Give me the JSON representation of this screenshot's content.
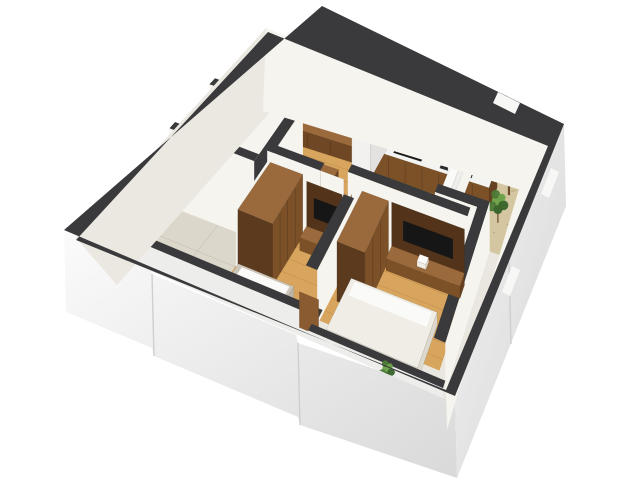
{
  "meta": {
    "description": "3D isometric cutaway render of an apartment floor plan with living room, kitchen, two bedrooms, bathrooms and balcony"
  },
  "palette": {
    "cap": "#3a3a3c",
    "white_face": "#f6f4ef",
    "shadow_face": "#ebe8e1",
    "wall_lower": "#ededeb",
    "wood_floor": "#d8a55e",
    "plank": "#a87434",
    "tile": "#dcd7cb",
    "tile_seam": "#c6bfaf",
    "balc_tile": "#d3c6a0",
    "balc_dot": "#b3a176",
    "entry_floor": "#eae7e0",
    "wood_mid": "#7c5128",
    "wood_light": "#9a6a3c",
    "wood_dark": "#5b3a1e",
    "wood_side": "#674021",
    "console": "#6f4724",
    "panel": "#53341a",
    "niche": "#3a2614",
    "slat": "#8a6239",
    "slat_gap": "#f1ede4",
    "counter": "#f3f3f1",
    "tv_black": "#161616",
    "cooktop": "#1b1b1b",
    "sink": "#2b2b2b",
    "sink_grate": "#121212",
    "fridge_top": "#ececea",
    "fridge_front": "#f2f1ef",
    "fridge_side": "#e3e2e0",
    "door": "#8a5a30",
    "frame": "#a9743f",
    "bed_gray": "#ccc5b8",
    "bed_gray_d": "#bdb5a6",
    "bed_white": "#efede6",
    "bed_white_d": "#ddd9cf",
    "pillow": "#fafaf8",
    "green1": "#4c7a36",
    "green2": "#6aa148",
    "green3": "#38642a",
    "trunk": "#6b4a2a",
    "window_white": "#f7f7f5",
    "facade_seam": "#cfcfcf"
  },
  "scene": [
    {
      "op": "raw",
      "name": "exterior-facade-sw",
      "fill": "url(#gradSW)",
      "pts": [
        [
          64,
          230
        ],
        [
          150,
          266
        ],
        [
          152,
          274
        ],
        [
          296,
          335
        ],
        [
          298,
          343
        ],
        [
          455,
          396
        ],
        [
          457,
          478
        ],
        [
          300,
          425
        ],
        [
          298,
          417
        ],
        [
          154,
          356
        ],
        [
          152,
          348
        ],
        [
          66,
          312
        ]
      ]
    },
    {
      "op": "rawline",
      "name": "facade-sw-seam-1",
      "stroke": "facade_seam",
      "sw": 1.4,
      "pts": [
        [
          152,
          274
        ],
        [
          154,
          356
        ]
      ]
    },
    {
      "op": "rawline",
      "name": "facade-sw-seam-2",
      "stroke": "facade_seam",
      "sw": 1.4,
      "pts": [
        [
          298,
          343
        ],
        [
          300,
          425
        ]
      ]
    },
    {
      "op": "raw",
      "name": "exterior-facade-se",
      "fill": "url(#gradSE)",
      "pts": [
        [
          564,
          124
        ],
        [
          455,
          396
        ],
        [
          457,
          478
        ],
        [
          566,
          206
        ]
      ]
    },
    {
      "op": "rawline",
      "name": "facade-se-seam",
      "stroke": "facade_seam",
      "sw": 1.4,
      "pts": [
        [
          509,
          262
        ],
        [
          511,
          344
        ]
      ]
    },
    {
      "op": "planks",
      "name": "floor-living-kitchen",
      "r": [
        0.02,
        0.02,
        0.78,
        0.455
      ],
      "z": 0,
      "fill": "wood_floor",
      "step": 0.05
    },
    {
      "op": "planks",
      "name": "floor-hallway",
      "r": [
        0.44,
        0.42,
        0.56,
        0.5
      ],
      "z": 0,
      "fill": "wood_floor",
      "step": 0.05
    },
    {
      "op": "planks",
      "name": "floor-bedroom1",
      "r": [
        0.26,
        0.49,
        0.555,
        0.8
      ],
      "z": 0,
      "fill": "wood_floor",
      "step": 0.06
    },
    {
      "op": "planks",
      "name": "floor-bedroom2",
      "r": [
        0.555,
        0.455,
        0.93,
        0.87
      ],
      "z": 0,
      "fill": "wood_floor",
      "step": 0.06
    },
    {
      "op": "tiles",
      "name": "floor-bathroom1",
      "r": [
        0.02,
        0.3,
        0.26,
        0.585
      ],
      "z": 0,
      "fill": "tile"
    },
    {
      "op": "tiles",
      "name": "floor-bathroom2",
      "r": [
        0.02,
        0.585,
        0.26,
        0.8
      ],
      "z": 0,
      "fill": "tile"
    },
    {
      "op": "quad",
      "name": "floor-entry-corridor",
      "r": [
        -0.02,
        0.8,
        0.97,
        1.01
      ],
      "z": 0,
      "fill": "entry_floor"
    },
    {
      "op": "quad",
      "name": "floor-corridor-se",
      "r": [
        0.93,
        0.3,
        1.02,
        0.87
      ],
      "z": 0,
      "fill": "entry_floor"
    },
    {
      "op": "quad",
      "name": "floor-balcony",
      "r": [
        0.815,
        -0.03,
        1.03,
        0.3
      ],
      "z": 0,
      "fill": "balc_tile"
    },
    {
      "op": "dots",
      "name": "balcony-floor-speckle",
      "r": [
        0.82,
        0.0,
        1.0,
        0.28
      ],
      "n": 26,
      "fill": "balc_dot"
    },
    {
      "op": "raw",
      "name": "wall-nw-interior-face",
      "fill": "shadow_face",
      "pts": [
        [
          266,
          28
        ],
        [
          76,
          238
        ],
        [
          117,
          285
        ],
        [
          272,
          110
        ]
      ]
    },
    {
      "op": "raw",
      "name": "wall-ne-interior-face",
      "fill": "white_face",
      "pts": [
        [
          266,
          28
        ],
        [
          552,
          146
        ],
        [
          531,
          193
        ],
        [
          263,
          111
        ]
      ]
    },
    {
      "op": "raw",
      "name": "wall-se-interior-face",
      "fill": "white_face",
      "pts": [
        [
          552,
          146
        ],
        [
          446,
          392
        ],
        [
          447,
          430
        ],
        [
          519,
          189
        ]
      ]
    },
    {
      "op": "slabV",
      "name": "entrance-door-frame",
      "u": 0.024,
      "v1": 0.095,
      "v2": 0.225,
      "z1": 0,
      "z2": 69,
      "fill": "frame"
    },
    {
      "op": "slabV",
      "name": "entrance-door",
      "u": 0.025,
      "v1": 0.105,
      "v2": 0.215,
      "z1": 2,
      "z2": 66,
      "fill": "door"
    },
    {
      "op": "slabU",
      "name": "slat-wall-backing",
      "v": 0.045,
      "u1": 0.02,
      "u2": 0.45,
      "z1": 2,
      "z2": 76,
      "fill": "slat_gap"
    },
    {
      "op": "slats",
      "name": "slat-accent-wall",
      "v": 0.042,
      "u1": 0.035,
      "u2": 0.445,
      "z1": 3,
      "z2": 75,
      "count": 21,
      "fill": "slat"
    },
    {
      "op": "box",
      "name": "tv-console-living",
      "r": [
        0.06,
        0.05,
        0.4,
        0.135
      ],
      "h2": 16,
      "top": "wood_light",
      "uf": "wood_side",
      "vf": "console",
      "seamsU": 3
    },
    {
      "op": "slabU",
      "name": "tv-living",
      "v": 0.06,
      "u1": 0.15,
      "u2": 0.315,
      "z1": 18,
      "z2": 46,
      "fill": "tv_black"
    },
    {
      "op": "box",
      "name": "desk-living",
      "r": [
        0.26,
        0.25,
        0.4,
        0.33
      ],
      "h2": 17,
      "top": "wood_light",
      "uf": "wood_side",
      "vf": "wood_mid"
    },
    {
      "op": "box",
      "name": "desk-item",
      "r": [
        0.3,
        0.27,
        0.345,
        0.305
      ],
      "h1": 17,
      "h2": 21,
      "top": "pillow",
      "uf": "bed_white_d",
      "vf": "bed_white"
    },
    {
      "op": "box",
      "name": "kitchen-upper-cabinets",
      "r": [
        0.48,
        0.02,
        0.92,
        0.085
      ],
      "h1": 44,
      "h2": 75,
      "top": "wood_dark",
      "uf": "wood_side",
      "vf": "wood_mid",
      "seamsU": 5
    },
    {
      "op": "slabU",
      "name": "kitchen-open-shelf-niche",
      "v": 0.086,
      "u1": 0.6,
      "u2": 0.715,
      "z1": 50,
      "z2": 68,
      "fill": "niche"
    },
    {
      "op": "line",
      "name": "kitchen-shelf-line",
      "a": [
        0.6,
        0.086,
        59
      ],
      "b": [
        0.715,
        0.086,
        59
      ],
      "stroke": "wood_light",
      "sw": 1.5
    },
    {
      "op": "box",
      "name": "kitchen-lower-cabinets",
      "r": [
        0.48,
        0.055,
        0.92,
        0.155
      ],
      "h2": 24,
      "top": "counter",
      "uf": "wood_side",
      "vf": "wood_mid",
      "seamsU": 6
    },
    {
      "op": "quad",
      "name": "cooktop",
      "r": [
        0.555,
        0.075,
        0.66,
        0.14
      ],
      "z": 24.4,
      "fill": "cooktop"
    },
    {
      "op": "quad",
      "name": "kitchen-sink",
      "r": [
        0.73,
        0.072,
        0.85,
        0.142
      ],
      "z": 24.4,
      "fill": "sink"
    },
    {
      "op": "quad",
      "name": "sink-grate-left",
      "r": [
        0.74,
        0.082,
        0.785,
        0.133
      ],
      "z": 24.8,
      "fill": "sink_grate"
    },
    {
      "op": "quad",
      "name": "sink-grate-right",
      "r": [
        0.795,
        0.082,
        0.84,
        0.133
      ],
      "z": 24.8,
      "fill": "sink_grate"
    },
    {
      "op": "dot",
      "name": "faucet",
      "u": 0.79,
      "v": 0.068,
      "z": 28,
      "rad": 2,
      "fill": "#a5a5a5"
    },
    {
      "op": "box",
      "name": "fridge-tall-unit",
      "r": [
        0.415,
        0.03,
        0.485,
        0.175
      ],
      "h2": 62,
      "top": "fridge_top",
      "uf": "fridge_side",
      "vf": "fridge_front"
    },
    {
      "op": "box",
      "name": "fridge-overhead-shelf",
      "r": [
        0.415,
        0.02,
        0.615,
        0.1
      ],
      "h1": 62,
      "h2": 70,
      "top": "wood_mid",
      "uf": "wood_side",
      "vf": "wood_light"
    },
    {
      "op": "box",
      "name": "wine-shelf",
      "r": [
        0.5,
        0.03,
        0.565,
        0.105
      ],
      "h1": 30,
      "h2": 58,
      "top": "wood_dark",
      "uf": "wood_side",
      "vf": "wood_mid",
      "seamsU": 2
    },
    {
      "op": "wall",
      "name": "wall-balcony-west",
      "r": [
        0.78,
        -0.02,
        0.815,
        0.3
      ],
      "z": 78,
      "faces": [
        {
          "side": "+u",
          "fill": "white_face"
        }
      ]
    },
    {
      "op": "box",
      "name": "balcony-window-sill",
      "r": [
        0.782,
        0.05,
        0.813,
        0.27
      ],
      "h1": 24,
      "h2": 38,
      "top": "#fafaf8",
      "uf": "#eeeeec",
      "vf": "#f2f2f0"
    },
    {
      "op": "wall",
      "name": "wall-balcony-south",
      "r": [
        0.78,
        0.3,
        0.965,
        0.335
      ],
      "z": 50,
      "faces": [
        {
          "side": "+v",
          "fill": "white_face"
        }
      ]
    },
    {
      "op": "plant",
      "name": "plant-balcony-large",
      "u": 0.97,
      "v": 0.07,
      "z": 0,
      "s": 1.0
    },
    {
      "op": "plant",
      "name": "plant-balcony-small",
      "u": 0.962,
      "v": 0.185,
      "z": 0,
      "s": 0.55
    },
    {
      "op": "wall",
      "name": "wall-bathroom-north",
      "r": [
        -0.02,
        0.3,
        0.26,
        0.335
      ],
      "z": 78,
      "faces": [
        {
          "side": "+v",
          "fill": "white_face"
        }
      ]
    },
    {
      "op": "wall",
      "name": "wall-bathroom-east",
      "r": [
        0.26,
        0.3,
        0.295,
        0.8
      ],
      "z": 78,
      "faces": [
        {
          "side": "+u",
          "fill": "white_face"
        }
      ]
    },
    {
      "op": "wall",
      "name": "wall-bathroom-divider",
      "r": [
        -0.02,
        0.55,
        0.26,
        0.585
      ],
      "z": 78,
      "faces": [
        {
          "side": "+v",
          "fill": "white_face"
        }
      ]
    },
    {
      "op": "wall",
      "name": "wall-living-bedroom1",
      "r": [
        0.26,
        0.455,
        0.44,
        0.49
      ],
      "z": 70,
      "faces": [
        {
          "side": "+v",
          "fill": "white_face"
        }
      ]
    },
    {
      "op": "wall",
      "name": "wall-living-bedroom2",
      "r": [
        0.52,
        0.42,
        0.93,
        0.455
      ],
      "z": 70,
      "faces": [
        {
          "side": "+v",
          "fill": "white_face"
        }
      ]
    },
    {
      "op": "slabV",
      "name": "hall-door-jamb-left",
      "u": 0.44,
      "v1": 0.42,
      "v2": 0.49,
      "z1": 0,
      "z2": 40,
      "fill": "frame"
    },
    {
      "op": "slabV",
      "name": "hall-door-jamb-right",
      "u": 0.52,
      "v1": 0.42,
      "v2": 0.49,
      "z1": 0,
      "z2": 40,
      "fill": "frame"
    },
    {
      "op": "slabU",
      "name": "hall-lintel",
      "v": 0.49,
      "u1": 0.44,
      "u2": 0.52,
      "z1": 34,
      "z2": 70,
      "fill": "white_face"
    },
    {
      "op": "box",
      "name": "wardrobe-bedroom1",
      "r": [
        0.275,
        0.5,
        0.385,
        0.74
      ],
      "h2": 62,
      "top": "wood_light",
      "uf": "wood_mid",
      "vf": "wood_dark",
      "seamsV": 3
    },
    {
      "op": "slabU",
      "name": "tv-panel-bedroom1",
      "v": 0.505,
      "u1": 0.4,
      "u2": 0.52,
      "z1": 4,
      "z2": 58,
      "fill": "panel"
    },
    {
      "op": "slabU",
      "name": "tv-bedroom1",
      "v": 0.506,
      "u1": 0.425,
      "u2": 0.505,
      "z1": 24,
      "z2": 44,
      "fill": "tv_black"
    },
    {
      "op": "box",
      "name": "dresser-bedroom1",
      "r": [
        0.4,
        0.505,
        0.52,
        0.56
      ],
      "h2": 13,
      "top": "wood_light",
      "uf": "wood_side",
      "vf": "wood_mid"
    },
    {
      "op": "box",
      "name": "deco-bedroom1",
      "r": [
        0.475,
        0.515,
        0.505,
        0.545
      ],
      "h1": 13,
      "h2": 18,
      "top": "pillow",
      "uf": "bed_white_d",
      "vf": "bed_white"
    },
    {
      "op": "box",
      "name": "bed-bedroom1",
      "r": [
        0.285,
        0.76,
        0.46,
        0.99
      ],
      "h2": 13,
      "top": "bed_gray",
      "uf": "bed_gray_d",
      "vf": "bed_gray_d"
    },
    {
      "op": "quad",
      "name": "pillow-bedroom1",
      "r": [
        0.3,
        0.77,
        0.45,
        0.83
      ],
      "z": 13.5,
      "fill": "pillow"
    },
    {
      "op": "wall",
      "name": "wall-bedroom1-bedroom2",
      "r": [
        0.52,
        0.49,
        0.555,
        0.82
      ],
      "z": 55,
      "faces": [
        {
          "side": "+u",
          "fill": "white_face"
        }
      ]
    },
    {
      "op": "wall",
      "name": "wall-bedroom2-east",
      "r": [
        0.93,
        0.3,
        0.965,
        0.87
      ],
      "z": 50,
      "faces": [
        {
          "side": "+u",
          "fill": "white_face"
        }
      ]
    },
    {
      "op": "box",
      "name": "wardrobe-bedroom2",
      "r": [
        0.575,
        0.47,
        0.665,
        0.7
      ],
      "h2": 60,
      "top": "wood_light",
      "uf": "wood_mid",
      "vf": "wood_dark",
      "seamsV": 2
    },
    {
      "op": "slabU",
      "name": "tv-panel-bedroom2",
      "v": 0.455,
      "u1": 0.67,
      "u2": 0.92,
      "z1": 4,
      "z2": 56,
      "fill": "panel"
    },
    {
      "op": "slabU",
      "name": "tv-bedroom2",
      "v": 0.456,
      "u1": 0.71,
      "u2": 0.88,
      "z1": 22,
      "z2": 42,
      "fill": "tv_black"
    },
    {
      "op": "box",
      "name": "dresser-bedroom2",
      "r": [
        0.67,
        0.455,
        0.92,
        0.51
      ],
      "h2": 12,
      "top": "wood_light",
      "uf": "wood_side",
      "vf": "wood_mid"
    },
    {
      "op": "box",
      "name": "deco-bedroom2",
      "r": [
        0.77,
        0.465,
        0.8,
        0.495
      ],
      "h1": 12,
      "h2": 17,
      "top": "pillow",
      "uf": "bed_white_d",
      "vf": "bed_white"
    },
    {
      "op": "box",
      "name": "bed-bedroom2",
      "r": [
        0.6,
        0.64,
        0.88,
        0.87
      ],
      "h2": 13,
      "top": "bed_white",
      "uf": "bed_white_d",
      "vf": "bed_white_d"
    },
    {
      "op": "quad",
      "name": "pillow-bedroom2",
      "r": [
        0.615,
        0.65,
        0.865,
        0.71
      ],
      "z": 13.5,
      "fill": "pillow"
    },
    {
      "op": "wall",
      "name": "wall-south-corridor",
      "r": [
        -0.02,
        0.8,
        0.565,
        0.835
      ],
      "z": 12,
      "faces": [
        {
          "side": "+v",
          "fill": "wall_lower",
          "zb": -60
        }
      ]
    },
    {
      "op": "slabU",
      "name": "door-corridor",
      "v": 0.835,
      "u1": 0.505,
      "u2": 0.565,
      "z1": -6,
      "z2": 30,
      "fill": "door"
    },
    {
      "op": "wall",
      "name": "wall-bedroom2-south",
      "r": [
        0.555,
        0.87,
        0.965,
        0.9
      ],
      "z": 12,
      "faces": [
        {
          "side": "+v",
          "fill": "wall_lower",
          "zb": -60
        }
      ]
    },
    {
      "op": "plant",
      "name": "plant-corridor",
      "u": 0.8,
      "v": 0.92,
      "z": -4,
      "s": 0.42
    },
    {
      "op": "ring",
      "name": "exterior-wall-cap-ring",
      "fill": "cap",
      "outer": [
        [
          322,
          6
        ],
        [
          564,
          124
        ],
        [
          455,
          396
        ],
        [
          64,
          230
        ]
      ],
      "inner": [
        [
          268,
          32
        ],
        [
          548,
          146
        ],
        [
          446,
          390
        ],
        [
          76,
          240
        ]
      ]
    },
    {
      "op": "raw",
      "name": "window-ne",
      "fill": "window_white",
      "pts": [
        [
          498,
          92
        ],
        [
          520,
          103
        ],
        [
          515,
          114
        ],
        [
          493,
          103
        ]
      ]
    },
    {
      "op": "raw",
      "name": "window-se-upper",
      "fill": "window_white",
      "pts": [
        [
          551,
          168
        ],
        [
          559,
          172
        ],
        [
          549,
          198
        ],
        [
          541,
          194
        ]
      ]
    },
    {
      "op": "raw",
      "name": "window-se-lower",
      "fill": "window_white",
      "pts": [
        [
          512,
          266
        ],
        [
          520,
          270
        ],
        [
          510,
          296
        ],
        [
          502,
          292
        ]
      ]
    }
  ]
}
